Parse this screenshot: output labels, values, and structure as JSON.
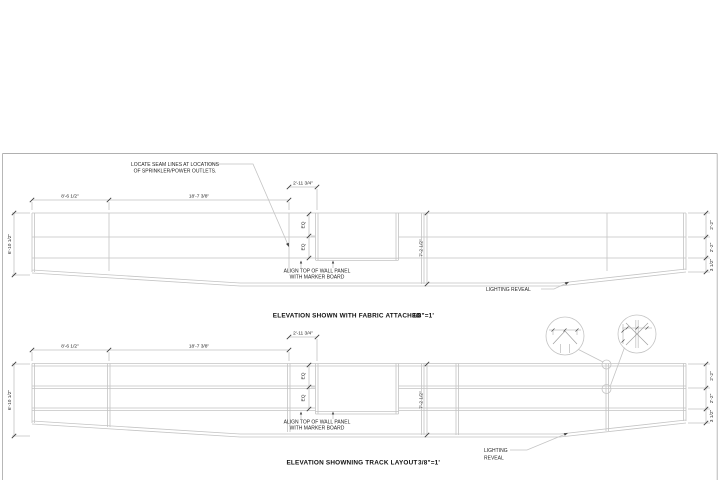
{
  "sheet": {
    "background": "#ffffff",
    "border_color": "#b0b0b0",
    "line_color": "#c4c4c4",
    "tick_color": "#3f3f3f",
    "text_color": "#262626"
  },
  "dimensions": {
    "panel_width_1": "8'-6 1/2\"",
    "panel_width_2": "18'-7 3/8\"",
    "notch_width": "2'-11 3/4\"",
    "total_height": "6'-10 1/2\"",
    "band_height_1": "2'-2\"",
    "band_height_2": "2'-2\"",
    "reveal_height": "3 1/2\"",
    "eq_upper": "EQ",
    "eq_lower": "EQ",
    "panel_height": "7'-2 1/2\""
  },
  "notes": {
    "seam_line_1": "LOCATE SEAM LINES AT LOCATIONS",
    "seam_line_2": "OF SPRINKLER/POWER OUTLETS.",
    "align_line_1": "ALIGN TOP OF WALL PANEL",
    "align_line_2": "WITH MARKER BOARD",
    "lighting_reveal_inline": "LIGHTING REVEAL",
    "lighting_line_1": "LIGHTING",
    "lighting_line_2": "REVEAL"
  },
  "top_elevation": {
    "title": "ELEVATION SHOWN WITH FABRIC ATTACHED",
    "scale": "3/8\"=1'"
  },
  "bottom_elevation": {
    "title": "ELEVATION SHOWNING TRACK LAYOUT",
    "scale": "3/8\"=1'"
  }
}
